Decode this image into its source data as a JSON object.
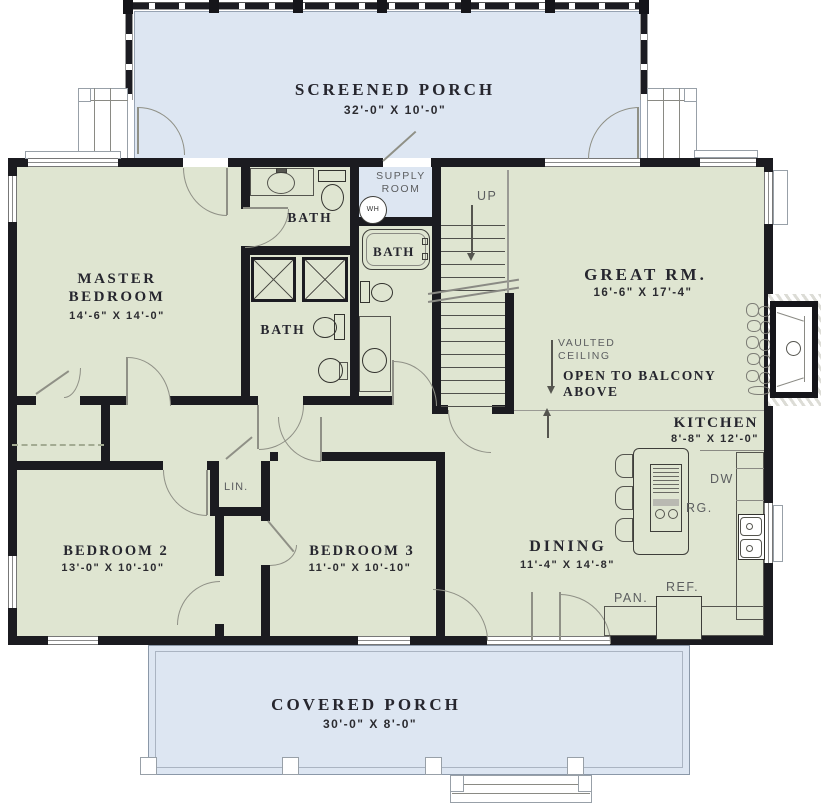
{
  "colors": {
    "wall": "#1b1b20",
    "room_fill": "#dfe5d1",
    "porch_fill": "#dde6f2",
    "text_dark": "#26262e",
    "text_gray": "#5c5e60"
  },
  "rooms": {
    "screened_porch": {
      "name": "SCREENED PORCH",
      "dims": "32'-0\" X 10'-0\""
    },
    "master_bedroom": {
      "name": "MASTER BEDROOM",
      "dims": "14'-6\" X 14'-0\""
    },
    "great_room": {
      "name": "GREAT RM.",
      "dims": "16'-6\" X 17'-4\""
    },
    "kitchen": {
      "name": "KITCHEN",
      "dims": "8'-8\" X 12'-0\""
    },
    "dining": {
      "name": "DINING",
      "dims": "11'-4\" X 14'-8\""
    },
    "bedroom_2": {
      "name": "BEDROOM 2",
      "dims": "13'-0\" X 10'-10\""
    },
    "bedroom_3": {
      "name": "BEDROOM 3",
      "dims": "11'-0\" X 10'-10\""
    },
    "covered_porch": {
      "name": "COVERED PORCH",
      "dims": "30'-0\" X 8'-0\""
    },
    "supply_room": {
      "line1": "SUPPLY",
      "line2": "ROOM"
    }
  },
  "labels": {
    "bath": "BATH",
    "up": "UP",
    "wh": "WH",
    "lin": "LIN.",
    "dw": "DW",
    "rg": "RG.",
    "ref": "REF.",
    "pan": "PAN."
  },
  "annotations": {
    "vaulted_ceiling": {
      "line1": "VAULTED",
      "line2": "CEILING"
    },
    "open_to_balcony": {
      "line1": "OPEN TO BALCONY",
      "line2": "ABOVE"
    }
  }
}
